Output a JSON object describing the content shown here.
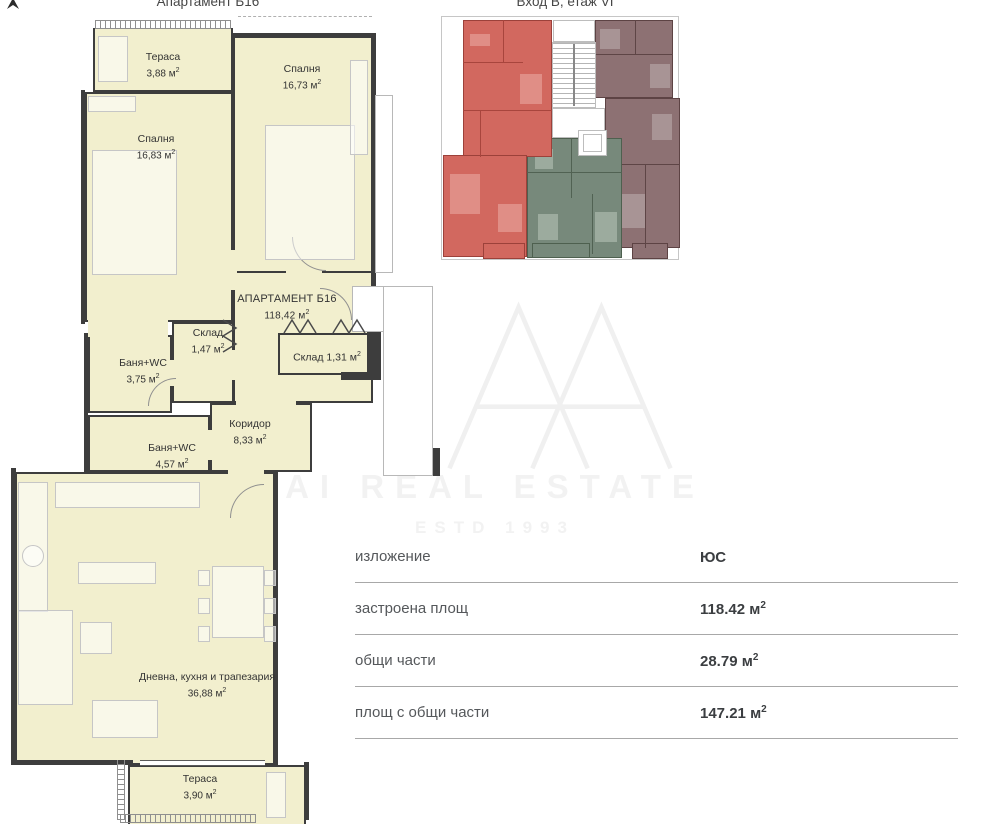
{
  "header": {
    "title_left": "Апартамент Б16",
    "title_right": "Вход В, етаж VI"
  },
  "units": {
    "sq": "м",
    "sup": "2"
  },
  "rooms": [
    {
      "name": "Тераса",
      "area": "3,88"
    },
    {
      "name": "Спалня",
      "area": "16,73"
    },
    {
      "name": "Спалня",
      "area": "16,83"
    },
    {
      "name": "АПАРТАМЕНТ Б16",
      "area": "118,42"
    },
    {
      "name": "Склад",
      "area": "1,47"
    },
    {
      "name": "Баня+WC",
      "area": "3,75"
    },
    {
      "name": "Склад",
      "area": "1,31"
    },
    {
      "name": "Коридор",
      "area": "8,33"
    },
    {
      "name": "Баня+WC",
      "area": "4,57"
    },
    {
      "name": "Дневна, кухня и трапезария",
      "area": "36,88"
    },
    {
      "name": "Тераса",
      "area": "3,90"
    }
  ],
  "details_table": {
    "rows": [
      {
        "label": "изложение",
        "value": "ЮС",
        "unit": "",
        "sup": ""
      },
      {
        "label": "застроена площ",
        "value": "118.42",
        "unit": "м",
        "sup": "2"
      },
      {
        "label": "общи части",
        "value": "28.79",
        "unit": "м",
        "sup": "2"
      },
      {
        "label": "площ с общи части",
        "value": "147.21",
        "unit": "м",
        "sup": "2"
      }
    ]
  },
  "watermark": {
    "line1": "AI REAL ESTATE",
    "line2": "ESTD 1993"
  },
  "colors": {
    "plan_fill": "#f2efce",
    "wall": "#3d3d3d",
    "mini_selected_red": "#d2685f",
    "mini_green": "#77897b",
    "mini_mauve": "#8d7173",
    "watermark_gray": "#f2f2f2"
  }
}
